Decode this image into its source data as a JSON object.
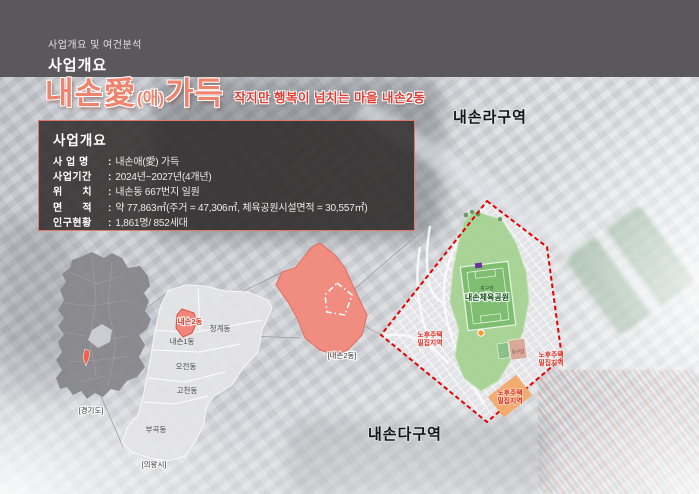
{
  "header": {
    "breadcrumb": "사업개요 및 여건분석",
    "title": "사업개요"
  },
  "hero": {
    "title_main": "내손愛",
    "title_paren": "(애)",
    "title_rest": "가득",
    "subtitle": "작지만 행복이 넘치는 마을 내손2동"
  },
  "info_box": {
    "title": "사업개요",
    "separator": ":",
    "rows": [
      {
        "label": "사 업 명",
        "value": "내손애(愛) 가득"
      },
      {
        "label": "사업기간",
        "value": "2024년~2027년(4개년)"
      },
      {
        "label": "위      치",
        "value": "내손동 667번지 일원"
      },
      {
        "label": "면      적",
        "value": "약 77,863㎡(주거 = 47,306㎡, 체육공원시설면적 = 30,557㎡)"
      },
      {
        "label": "인구현황",
        "value": "1,861명/ 852세대"
      }
    ]
  },
  "region_map": {
    "province_label": "[경기도]",
    "city_label": "[의왕시]",
    "districts": {
      "naeson2": "내손2동",
      "cheonggye": "청계동",
      "naeson1": "내손1동",
      "ojeon": "오전동",
      "gocheon": "고천동",
      "bugok": "부곡동"
    },
    "highlight_label": "[내손2동]"
  },
  "detail_map": {
    "zone_top": "내손라구역",
    "zone_bottom": "내손다구역",
    "park_name": "내손체육공원",
    "soccer_field": "축구장",
    "basketball_court": "농구장",
    "aging_housing": {
      "line1": "노후주택",
      "line2": "밀집지역"
    }
  },
  "colors": {
    "header_gray": "#5A585A",
    "accent_salmon": "#F0836E",
    "accent_red": "#E23B30",
    "boundary_red": "#E60000",
    "highlight_fill": "#F2867A",
    "park_green": "#A7D395",
    "field_green": "#7FBE71",
    "info_border": "#E0796B"
  }
}
